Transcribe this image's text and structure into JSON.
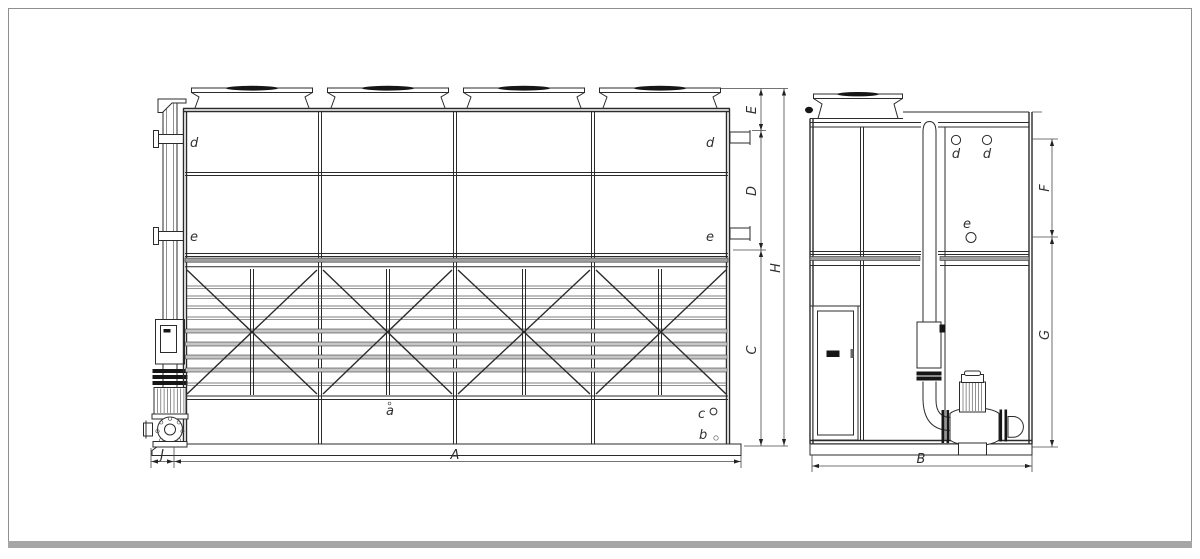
{
  "front_view": {
    "part_labels": {
      "d_left": "d",
      "e_left": "e",
      "d_right": "d",
      "e_right": "e",
      "a": "a",
      "b": "b",
      "c": "c"
    },
    "dimensions": {
      "E": "E",
      "D": "D",
      "C": "C",
      "H": "H",
      "A": "A",
      "J": "J"
    }
  },
  "side_view": {
    "part_labels": {
      "d_front": "d",
      "d_rear": "d",
      "e": "e"
    },
    "dimensions": {
      "F": "F",
      "G": "G",
      "B": "B"
    }
  },
  "colors": {
    "line": "#2b2b2b",
    "louver_fill": "#c6c6c6",
    "rail_fill": "#9e9e9e",
    "dark_fill": "#161616",
    "page_border": "#8f8f8f",
    "bottom_bar": "#a6a6a6"
  }
}
